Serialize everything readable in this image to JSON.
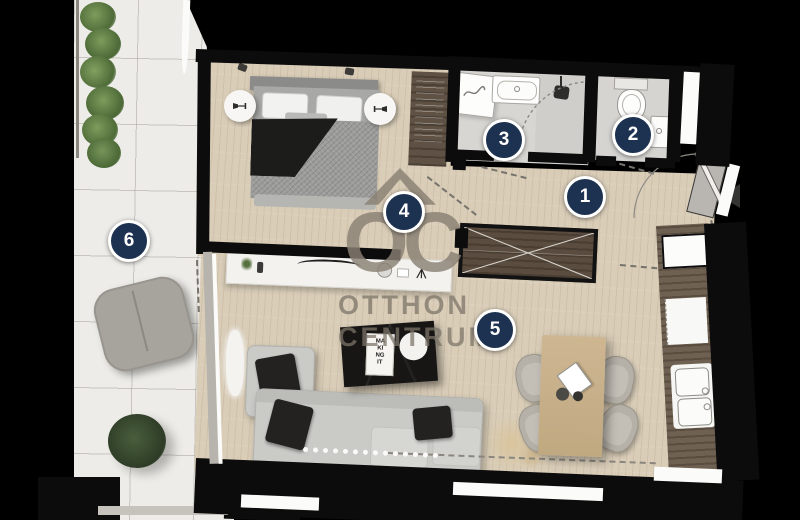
{
  "watermark": {
    "logo": "OC",
    "line1": "OTTHON",
    "line2": "CENTRUM"
  },
  "rooms": [
    {
      "number": "1"
    },
    {
      "number": "2"
    },
    {
      "number": "3"
    },
    {
      "number": "4"
    },
    {
      "number": "5"
    },
    {
      "number": "6"
    }
  ],
  "decor": {
    "magazine_text": "MA\nKI\nNG\nIT"
  },
  "icons": {
    "entrance_arrow": "left-pointing-triangle",
    "table_lamp": "lamp-glyph-in-circle",
    "shower_head": "dark-rounded-square-with-stem",
    "washing_machine": "hose-squiggle"
  },
  "palette": {
    "background": "#000000",
    "wall": "#0c0c0c",
    "wood_floor": "#d9cdb8",
    "terrace_tile": "#edece8",
    "bathroom_floor": "#d6d5d2",
    "marker_fill": "#1d3150",
    "marker_ring": "#ffffff",
    "watermark_gray": "#8a8174",
    "counter_wood": "#6f6152",
    "closet_wood": "#5a4c3e",
    "sofa_gray": "#cacac7",
    "dining_wood": "#cdb691",
    "plant_green": "#5b7a42",
    "lounger_gray": "#a7a49e"
  }
}
